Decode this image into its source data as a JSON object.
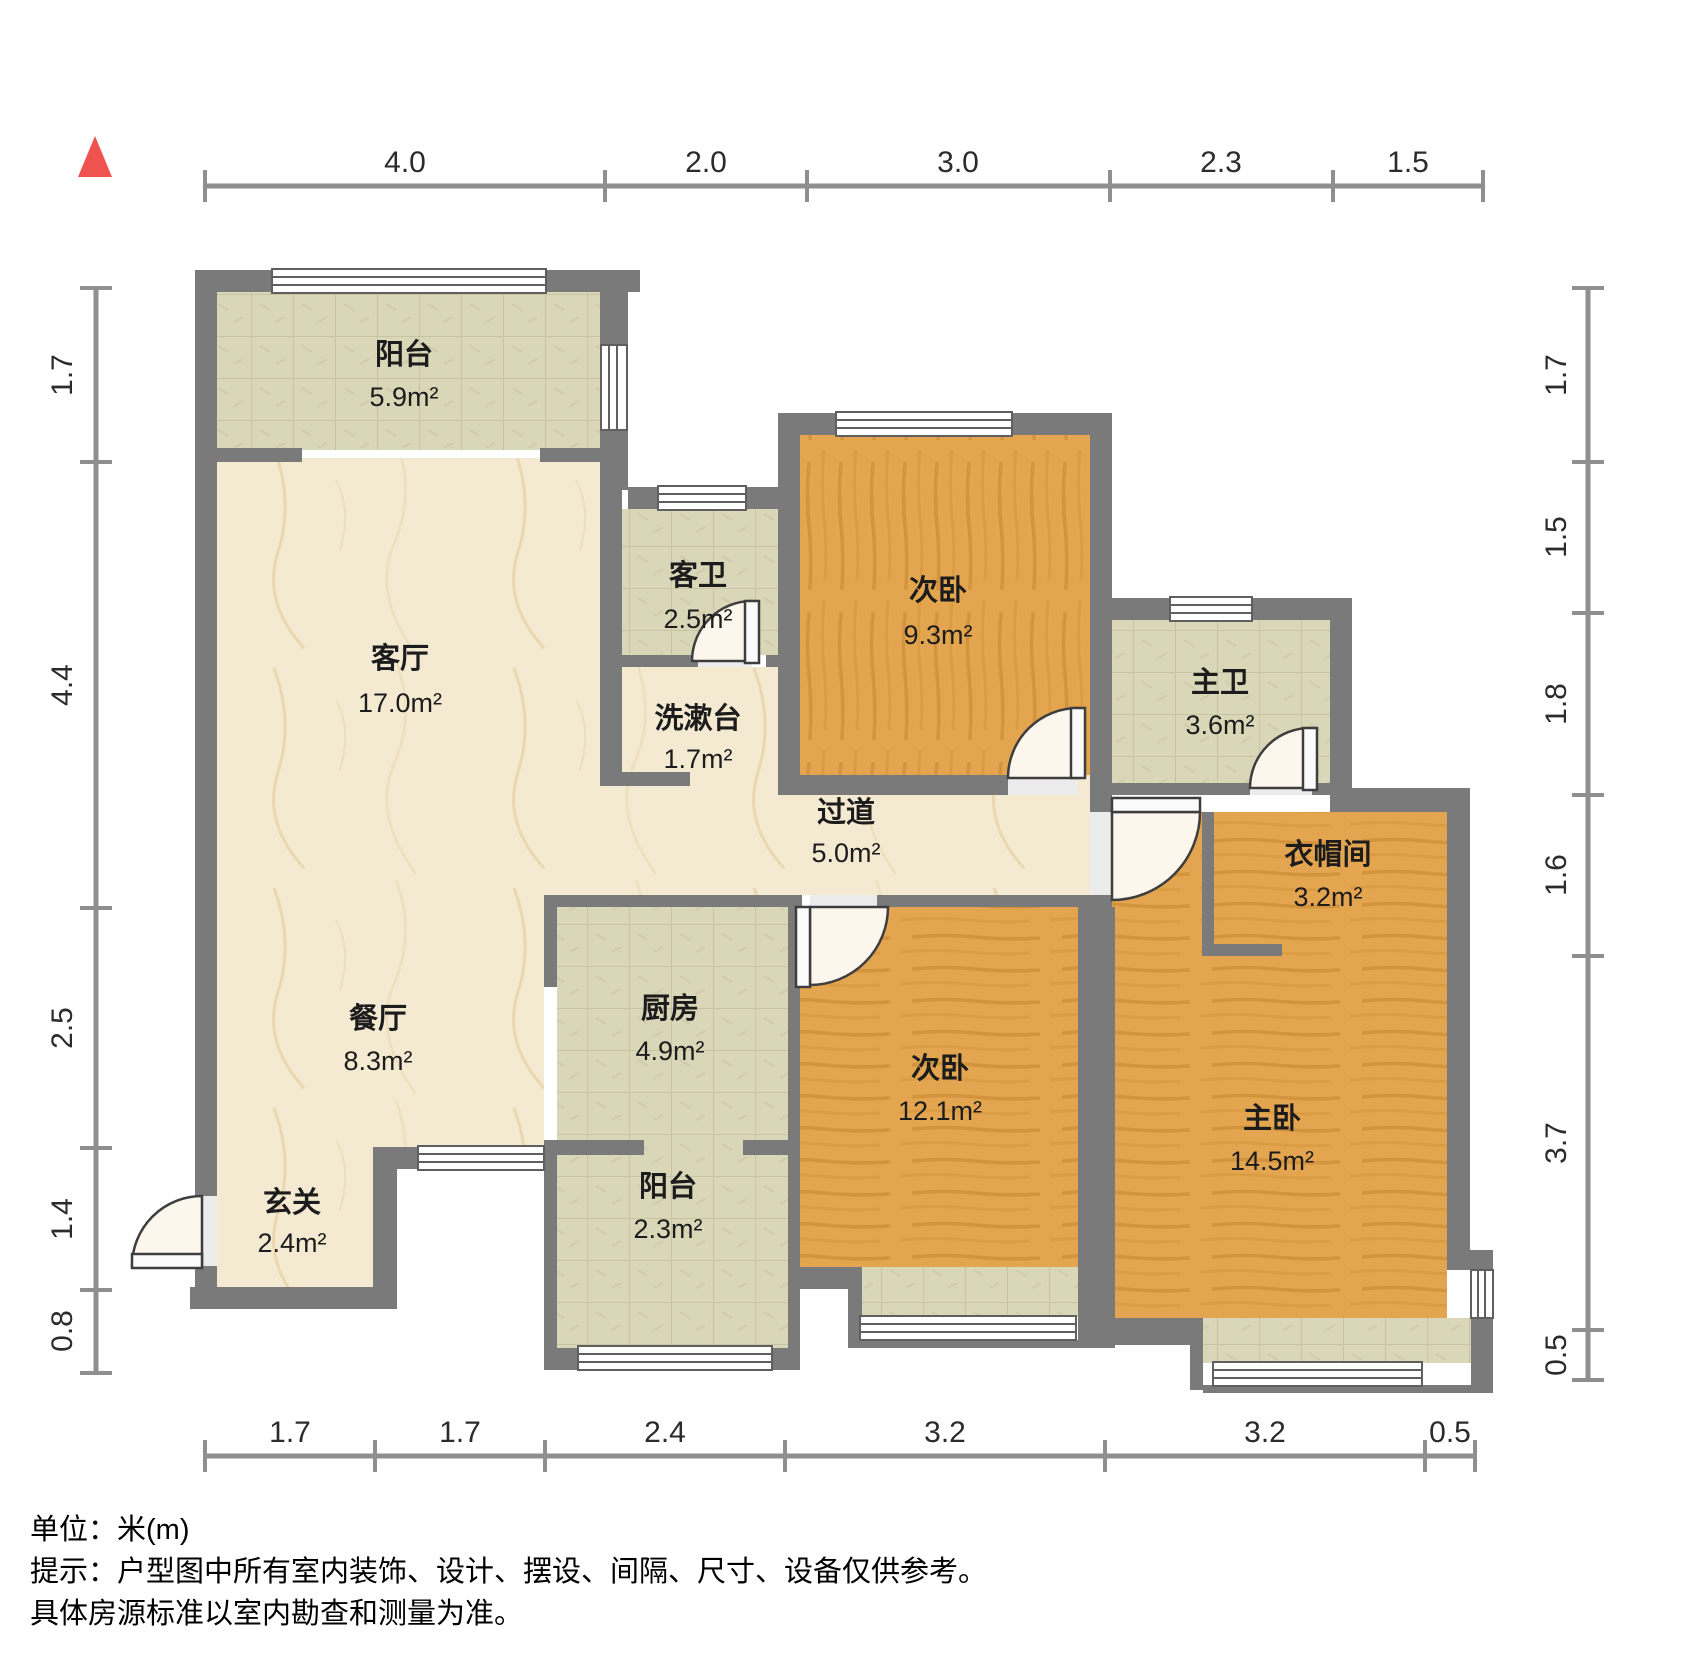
{
  "title": "户型图",
  "unit_scale": "米(m)",
  "rooms": [
    {
      "name": "阳台",
      "area": "5.9m²"
    },
    {
      "name": "客厅",
      "area": "17.0m²"
    },
    {
      "name": "客卫",
      "area": "2.5m²"
    },
    {
      "name": "洗漱台",
      "area": "1.7m²"
    },
    {
      "name": "次卧",
      "area": "9.3m²"
    },
    {
      "name": "主卫",
      "area": "3.6m²"
    },
    {
      "name": "过道",
      "area": "5.0m²"
    },
    {
      "name": "衣帽间",
      "area": "3.2m²"
    },
    {
      "name": "餐厅",
      "area": "8.3m²"
    },
    {
      "name": "厨房",
      "area": "4.9m²"
    },
    {
      "name": "次卧",
      "area": "12.1m²"
    },
    {
      "name": "主卧",
      "area": "14.5m²"
    },
    {
      "name": "玄关",
      "area": "2.4m²"
    },
    {
      "name": "阳台",
      "area": "2.3m²"
    }
  ],
  "dims": {
    "top": [
      "4.0",
      "2.0",
      "3.0",
      "2.3",
      "1.5"
    ],
    "left": [
      "1.7",
      "4.4",
      "2.5",
      "1.4",
      "0.8"
    ],
    "right": [
      "1.7",
      "1.5",
      "1.8",
      "1.6",
      "3.7",
      "0.5"
    ],
    "bottom": [
      "1.7",
      "1.7",
      "2.4",
      "3.2",
      "3.2",
      "0.5"
    ]
  },
  "footer": {
    "unit": "单位：米(m)",
    "tip1": "提示：户型图中所有室内装饰、设计、摆设、间隔、尺寸、设备仅供参考。",
    "tip2": "具体房源标准以室内勘查和测量为准。"
  },
  "colors": {
    "wall": "#7a7a7a",
    "wood_floor": "#e3a54f",
    "tile_floor": "#dad6b8",
    "marble_floor": "#f4ead2",
    "north_arrow": "#ef5350",
    "dim_line": "#8f8f8f",
    "text": "#1c1c1c"
  },
  "icons": {
    "north_arrow": "north-arrow"
  }
}
